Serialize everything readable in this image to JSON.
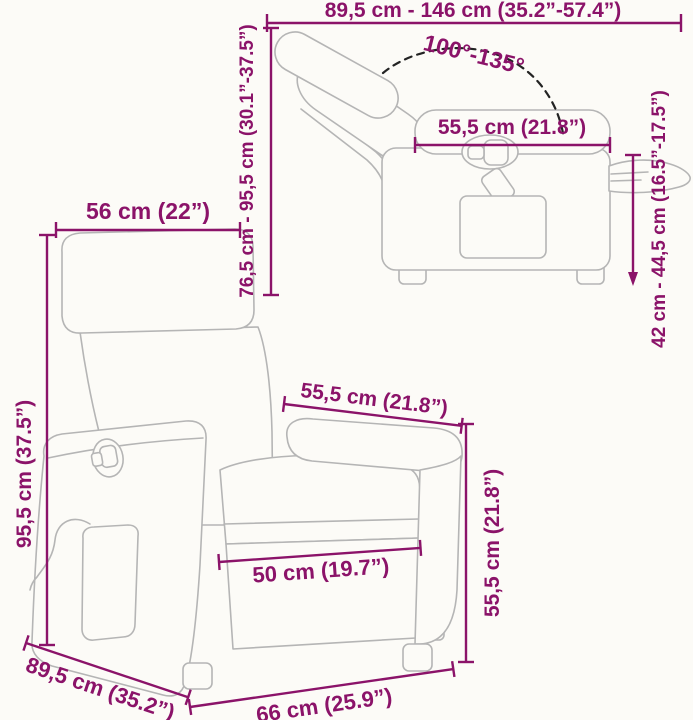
{
  "page": {
    "type": "product-dimension-diagram",
    "subject": "massage recliner chair, reclined side view and upright front view",
    "background": "#fcfbf7"
  },
  "colors": {
    "dimension": "#8B1369",
    "chair_outline": "#b5b5b5",
    "angle_arc": "#232323"
  },
  "reclined_view": {
    "total_length": "89,5 cm - 146 cm (35.2”-57.4”)",
    "recline_angle": "100°-135°",
    "height_range": "76,5 cm - 95,5 cm (30.1”-37.5”)",
    "armrest_length": "55,5 cm (21.8”)",
    "footrest_height": "42 cm - 44,5 cm (16.5”-17.5”)"
  },
  "upright_view": {
    "backrest_width": "56 cm (22”)",
    "total_height": "95,5 cm (37.5”)",
    "armrest_depth": "55,5 cm (21.8”)",
    "armrest_height": "55,5 cm (21.8”)",
    "seat_width": "50 cm (19.7”)",
    "depth": "89,5 cm (35.2”)",
    "base_width": "66 cm (25.9”)"
  }
}
